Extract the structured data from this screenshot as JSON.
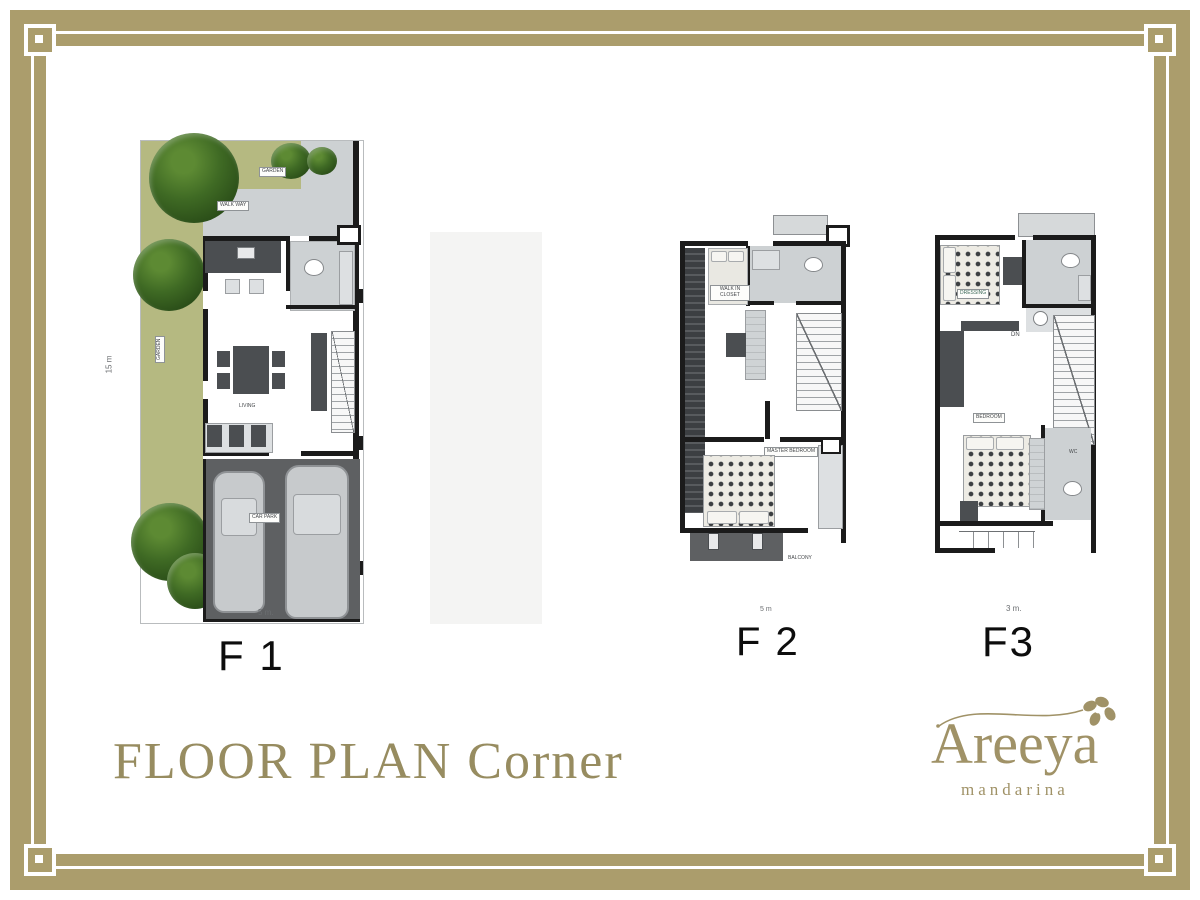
{
  "page": {
    "title": "FLOOR PLAN Corner",
    "brand": "Areeya",
    "brand_sub": "mandarina"
  },
  "colors": {
    "frame_gold": "#ab9d6c",
    "title_gold": "#978c60",
    "garden_green": "#b5b981",
    "tree_green": "#2f5519",
    "walk_gray": "#cdd1d3",
    "wall_black": "#1b1b1b",
    "furniture_dark": "#4b4e51",
    "carpark_gray": "#5e6062"
  },
  "plans": [
    {
      "label": "F 1",
      "dim_width": "5 m.",
      "dim_height": "15 m",
      "rooms": {
        "garden_top": "GARDEN",
        "walkway": "WALK WAY",
        "garden_side": "GARDEN",
        "living": "LIVING",
        "carpark": "CAR PARK"
      }
    },
    {
      "label": "F 2",
      "dim_width": "5 m",
      "rooms": {
        "walkin": "WALK IN CLOSET",
        "master": "MASTER BEDROOM",
        "balcony": "BALCONY"
      }
    },
    {
      "label": "F3",
      "dim_width": "3 m.",
      "rooms": {
        "dressing": "DRESSING",
        "dn": "DN",
        "bedroom": "BEDROOM",
        "wc": "WC"
      }
    }
  ]
}
